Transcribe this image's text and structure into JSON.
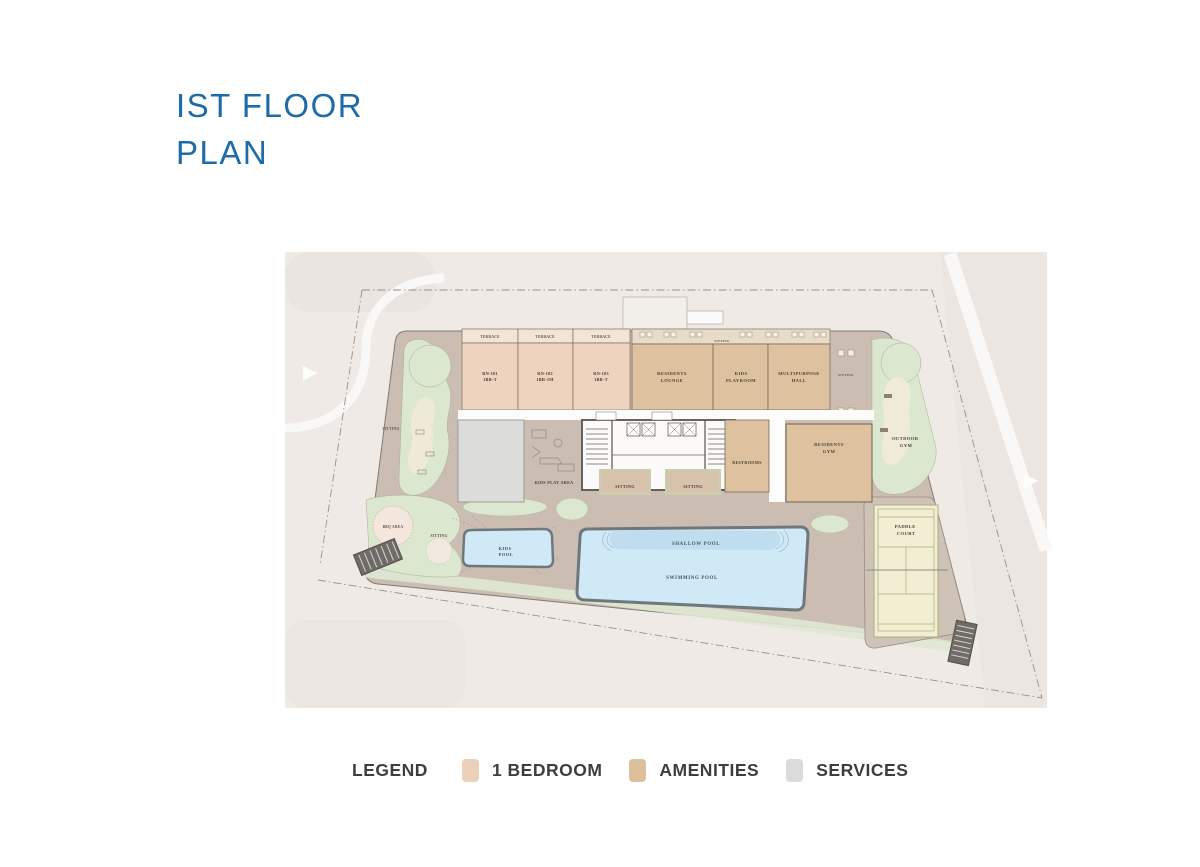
{
  "title": {
    "line1": "IST FLOOR",
    "line2": "PLAN"
  },
  "legend": {
    "heading": "LEGEND",
    "items": [
      {
        "name": "one-bedroom",
        "label": "1 BEDROOM",
        "color": "#ecd1ba"
      },
      {
        "name": "amenities",
        "label": "AMENITIES",
        "color": "#dcc09c"
      },
      {
        "name": "services",
        "label": "SERVICES",
        "color": "#dbdbdb"
      }
    ]
  },
  "plan": {
    "labels": {
      "terrace": "TERRACE",
      "unit1_id": "RN-101",
      "unit1_type": "1BR-T",
      "unit2_id": "RN-102",
      "unit2_type": "1BR-1M",
      "unit3_id": "RN-103",
      "unit3_type": "1BR-T",
      "residents_lounge_1": "RESIDENTS",
      "residents_lounge_2": "LOUNGE",
      "kids_playroom_1": "KIDS",
      "kids_playroom_2": "PLAYROOM",
      "multipurpose_hall_1": "MULTIPURPOSE",
      "multipurpose_hall_2": "HALL",
      "restrooms": "RESTROOMS",
      "residents_gym_1": "RESIDENTS",
      "residents_gym_2": "GYM",
      "outdoor_gym_1": "OUTDOOR",
      "outdoor_gym_2": "GYM",
      "paddle_court_1": "PADDLE",
      "paddle_court_2": "COURT",
      "kids_play_area": "KIDS PLAY AREA",
      "sitting": "SITTING",
      "kids_pool_1": "KIDS",
      "kids_pool_2": "POOL",
      "shallow_pool": "SHALLOW POOL",
      "swimming_pool": "SWIMMING POOL",
      "bbq_area": "BBQ AREA"
    },
    "colors": {
      "panel": "#efeae5",
      "ground": "#cbbdb2",
      "landscape": "#dce7d0",
      "one_bedroom": "#eed3bf",
      "terrace": "#f3e5d6",
      "amenities": "#dec29f",
      "amenity_terrace": "#e8dcc9",
      "services": "#dcdcdb",
      "pool_water": "#cfe9f7",
      "shallow_water": "#bedcee",
      "court": "#f3edd3"
    }
  }
}
